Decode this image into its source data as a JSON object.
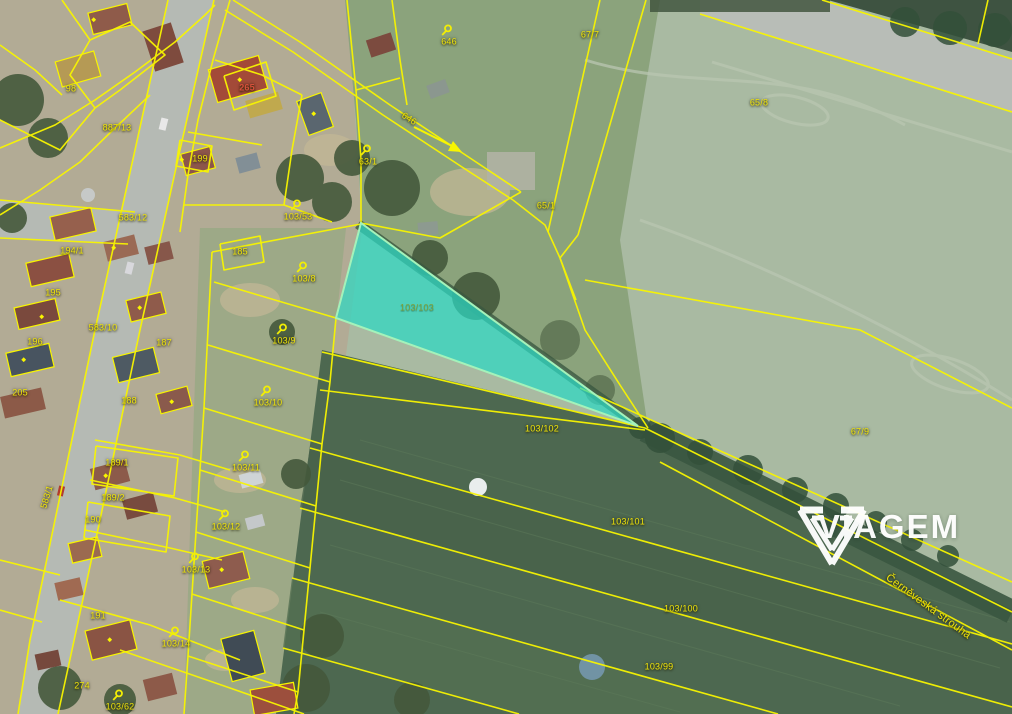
{
  "brand": {
    "name": "VIAGEM"
  },
  "map": {
    "highlight": {
      "parcel_number": "103/103",
      "fill_color": "rgba(44,216,196,0.72)",
      "border_color": "#a4f2ba"
    },
    "line_color": "#f8f500",
    "label_color": "#f0e40a",
    "building_label_color": "#d6503c",
    "labels": [
      {
        "text": "98",
        "x": 71,
        "y": 89
      },
      {
        "text": "887/13",
        "x": 117,
        "y": 128
      },
      {
        "text": "265",
        "x": 247,
        "y": 88,
        "role": "building"
      },
      {
        "text": "199",
        "x": 200,
        "y": 159
      },
      {
        "text": "646",
        "x": 449,
        "y": 42,
        "pin": true
      },
      {
        "text": "67/7",
        "x": 590,
        "y": 35
      },
      {
        "text": "65/8",
        "x": 759,
        "y": 103
      },
      {
        "text": "646",
        "x": 409,
        "y": 119,
        "rot": 33
      },
      {
        "text": "63/1",
        "x": 368,
        "y": 162,
        "pin": true
      },
      {
        "text": "65/1",
        "x": 546,
        "y": 206
      },
      {
        "text": "103/53",
        "x": 298,
        "y": 217,
        "pin": true
      },
      {
        "text": "583/12",
        "x": 133,
        "y": 218
      },
      {
        "text": "194/1",
        "x": 72,
        "y": 251
      },
      {
        "text": "185",
        "x": 240,
        "y": 252
      },
      {
        "text": "195",
        "x": 53,
        "y": 293
      },
      {
        "text": "103/8",
        "x": 304,
        "y": 279,
        "pin": true
      },
      {
        "text": "103/103",
        "x": 417,
        "y": 308,
        "role": "highlight"
      },
      {
        "text": "583/10",
        "x": 103,
        "y": 328
      },
      {
        "text": "196",
        "x": 35,
        "y": 342
      },
      {
        "text": "187",
        "x": 164,
        "y": 343
      },
      {
        "text": "103/9",
        "x": 284,
        "y": 341,
        "pin": true
      },
      {
        "text": "205",
        "x": 20,
        "y": 393
      },
      {
        "text": "188",
        "x": 129,
        "y": 401
      },
      {
        "text": "103/10",
        "x": 268,
        "y": 403,
        "pin": true
      },
      {
        "text": "103/102",
        "x": 542,
        "y": 429
      },
      {
        "text": "67/9",
        "x": 860,
        "y": 432
      },
      {
        "text": "189/1",
        "x": 117,
        "y": 463
      },
      {
        "text": "103/11",
        "x": 246,
        "y": 468,
        "pin": true
      },
      {
        "text": "583/1",
        "x": 47,
        "y": 497,
        "rot": -73
      },
      {
        "text": "189/2",
        "x": 113,
        "y": 498
      },
      {
        "text": "190",
        "x": 93,
        "y": 520
      },
      {
        "text": "103/101",
        "x": 628,
        "y": 522
      },
      {
        "text": "103/12",
        "x": 226,
        "y": 527,
        "pin": true
      },
      {
        "text": "103/13",
        "x": 196,
        "y": 570,
        "pin": true
      },
      {
        "text": "103/100",
        "x": 681,
        "y": 609
      },
      {
        "text": "191",
        "x": 98,
        "y": 616
      },
      {
        "text": "103/14",
        "x": 176,
        "y": 644,
        "pin": true
      },
      {
        "text": "103/99",
        "x": 659,
        "y": 667
      },
      {
        "text": "274",
        "x": 82,
        "y": 686
      },
      {
        "text": "103/62",
        "x": 120,
        "y": 707,
        "pin": true
      },
      {
        "text": "Černěveská strouha",
        "x": 928,
        "y": 607,
        "rot": 36,
        "role": "stream"
      }
    ]
  }
}
